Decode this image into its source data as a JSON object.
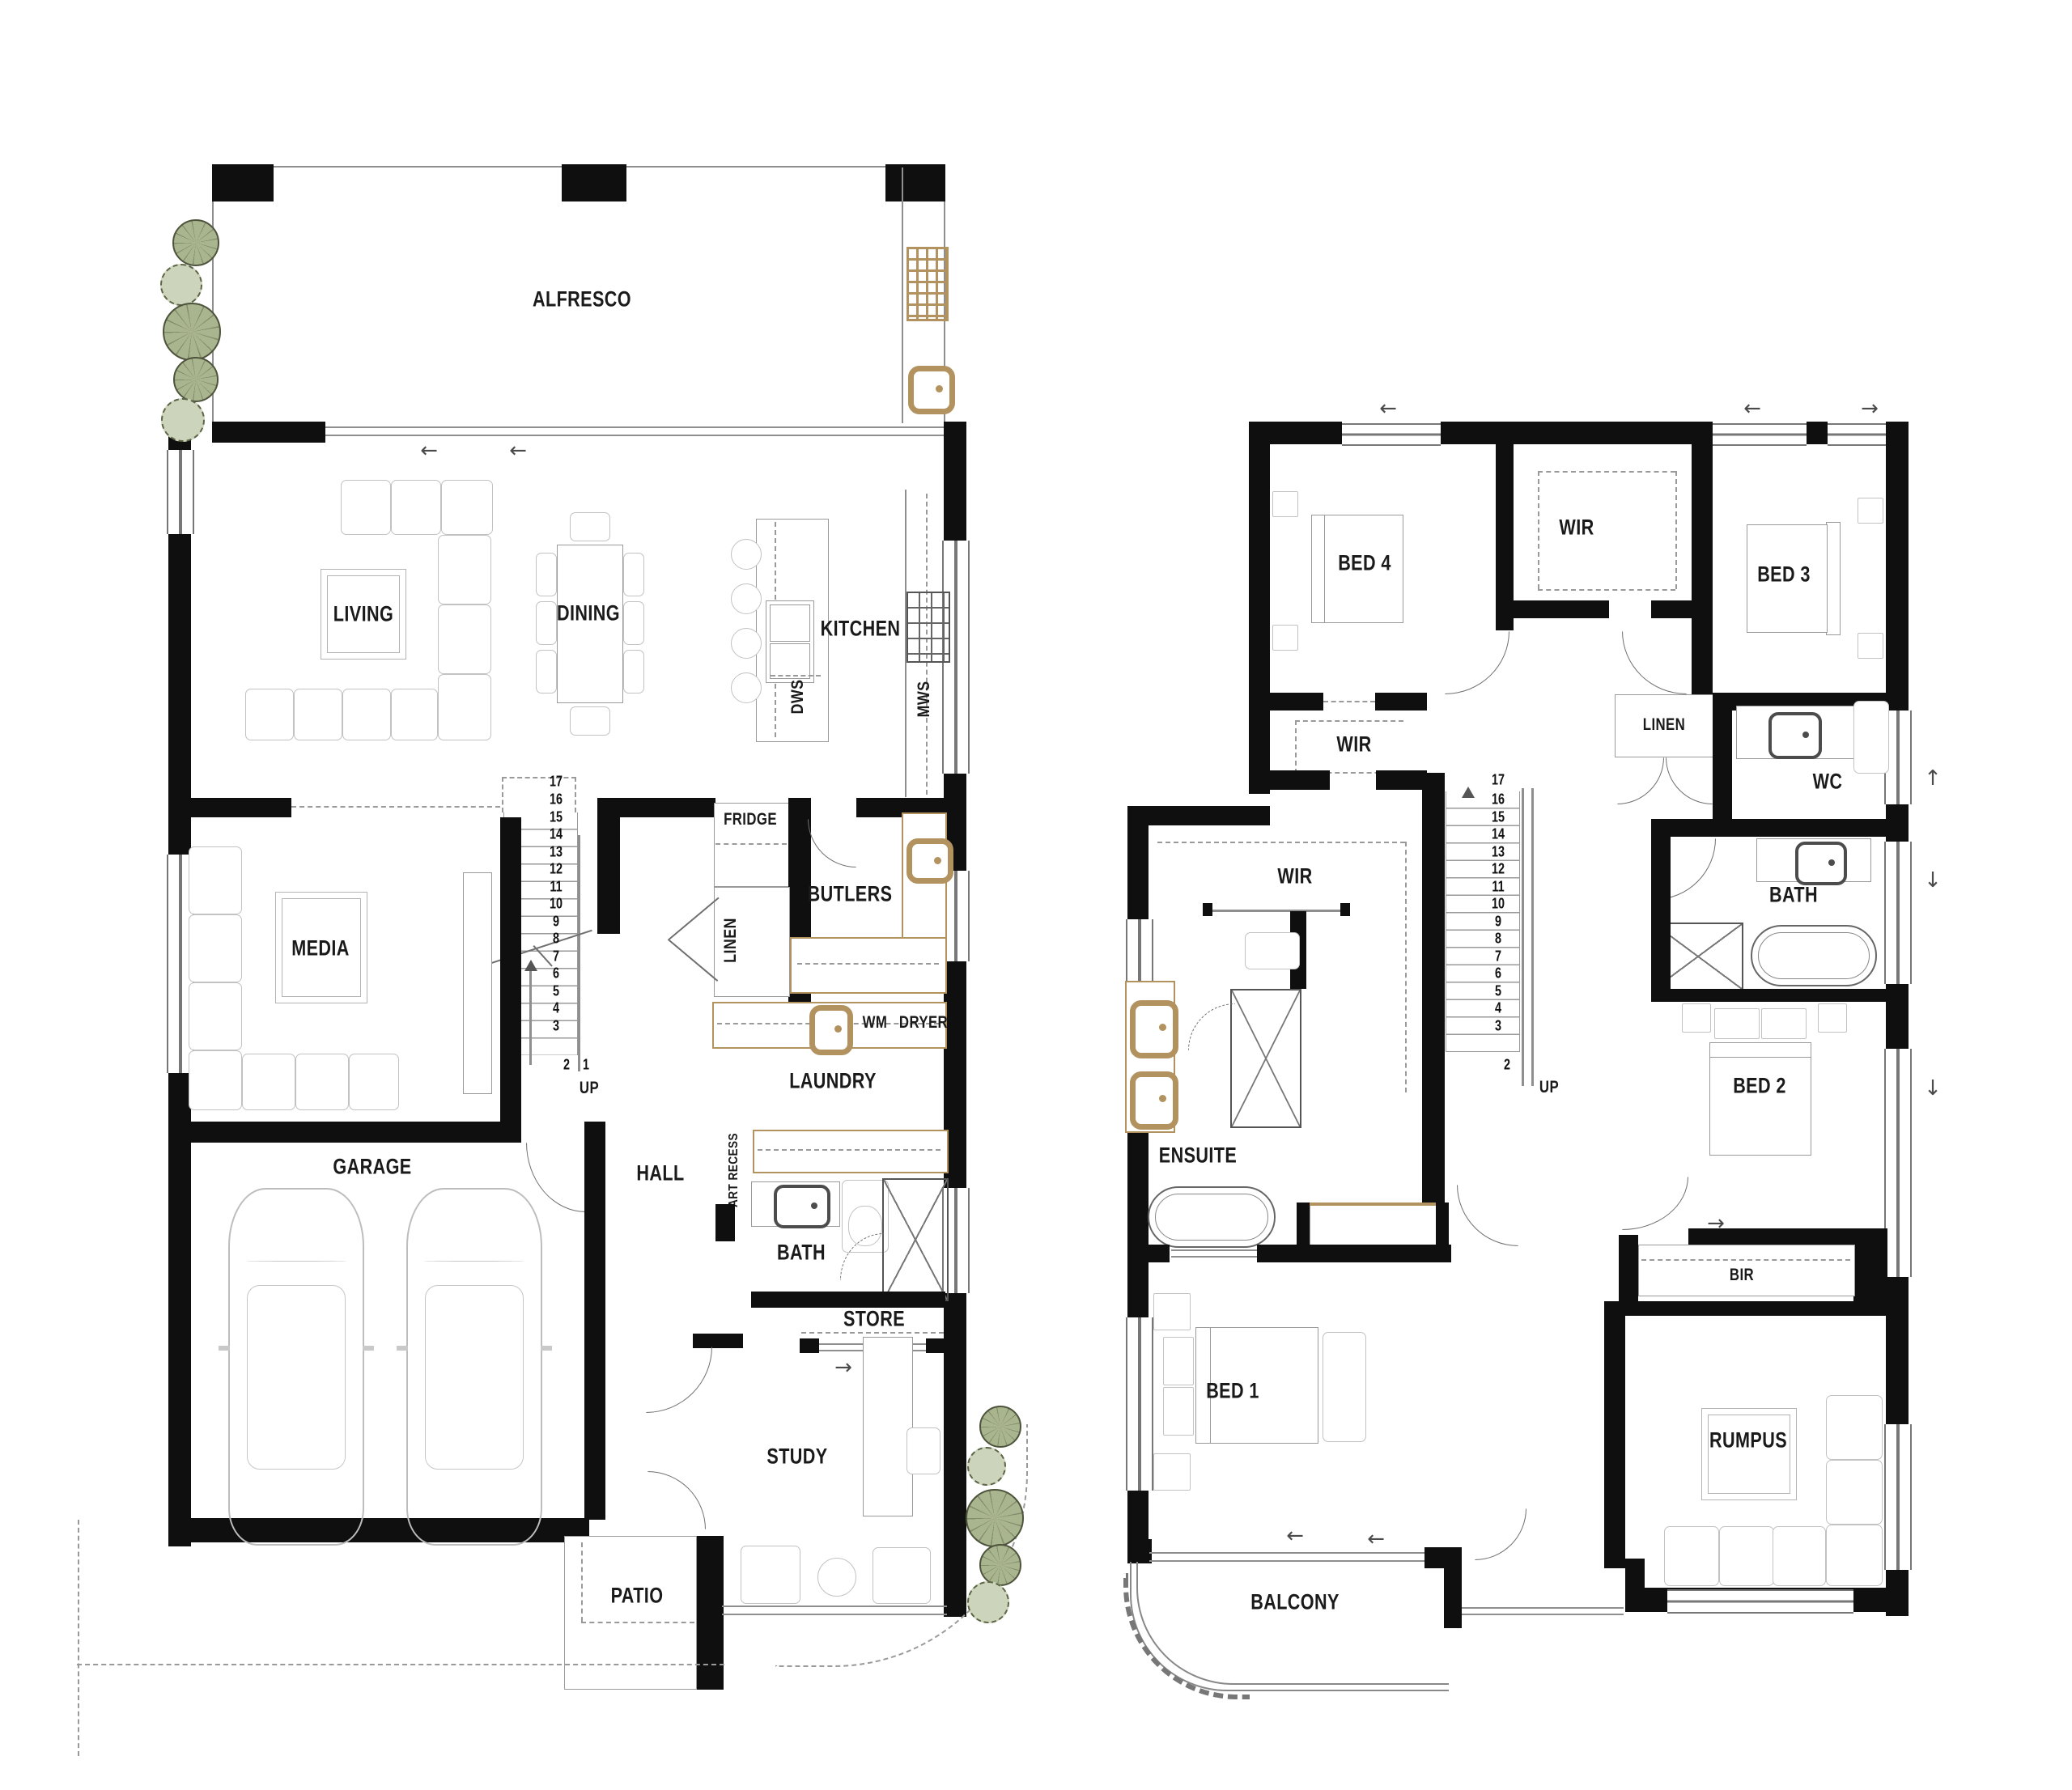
{
  "colors": {
    "wall": "#0f0f0f",
    "fixture_tan": "#b2925f",
    "tree_dark": "#a9b58e",
    "tree_light": "#cdd4bc",
    "furniture_line": "#c2c2c2"
  },
  "ground": {
    "rooms": {
      "alfresco": "ALFRESCO",
      "living": "LIVING",
      "dining": "DINING",
      "kitchen": "KITCHEN",
      "media": "MEDIA",
      "butlers": "BUTLERS",
      "laundry": "LAUNDRY",
      "garage": "GARAGE",
      "hall": "HALL",
      "bath": "BATH",
      "store": "STORE",
      "study": "STUDY",
      "patio": "PATIO"
    },
    "fixtures": {
      "fridge": "FRIDGE",
      "linen": "LINEN",
      "dws": "DWS",
      "mws": "MWS",
      "wm": "WM",
      "dryer": "DRYER",
      "art_recess": "ART RECESS",
      "up": "UP"
    },
    "stairs": [
      "17",
      "16",
      "15",
      "14",
      "13",
      "12",
      "11",
      "10",
      "9",
      "8",
      "7",
      "6",
      "5",
      "4",
      "3",
      "2",
      "1"
    ]
  },
  "upper": {
    "rooms": {
      "bed4": "BED 4",
      "wir_a": "WIR",
      "bed3": "BED 3",
      "wir_b": "WIR",
      "linen": "LINEN",
      "wc": "WC",
      "bath": "BATH",
      "wir_c": "WIR",
      "bed2": "BED 2",
      "ensuite": "ENSUITE",
      "bed1": "BED 1",
      "bir": "BIR",
      "rumpus": "RUMPUS",
      "balcony": "BALCONY"
    },
    "fixtures": {
      "up": "UP"
    },
    "stairs": [
      "17",
      "16",
      "15",
      "14",
      "13",
      "12",
      "11",
      "10",
      "9",
      "8",
      "7",
      "6",
      "5",
      "4",
      "3",
      "2"
    ]
  }
}
